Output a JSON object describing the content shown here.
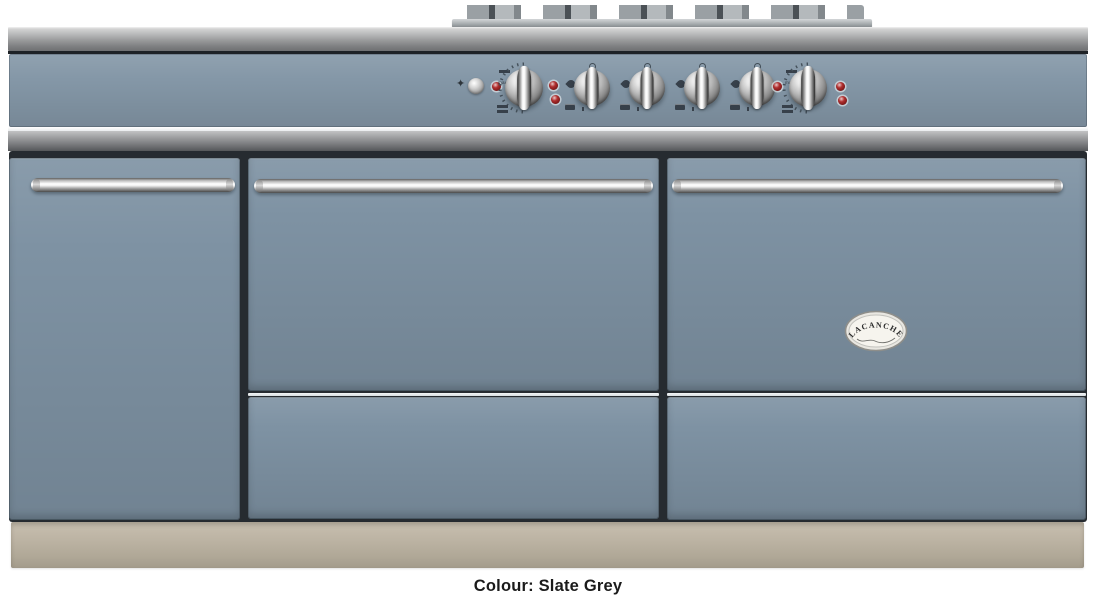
{
  "caption": {
    "text": "Colour: Slate Grey"
  },
  "badge": {
    "brand": "LACANCHE"
  },
  "control_panel": {
    "oven_scale_label": "maxi",
    "controls": [
      {
        "name": "ignition-spark-icon",
        "kind": "spark-symbol"
      },
      {
        "name": "ignition-button",
        "kind": "push-button"
      },
      {
        "name": "oven-knob-left",
        "kind": "oven-thermostat-knob"
      },
      {
        "name": "burner-knob-1",
        "kind": "gas-burner-knob"
      },
      {
        "name": "burner-knob-2",
        "kind": "gas-burner-knob"
      },
      {
        "name": "burner-knob-3",
        "kind": "gas-burner-knob"
      },
      {
        "name": "burner-knob-4",
        "kind": "gas-burner-knob"
      },
      {
        "name": "oven-knob-right",
        "kind": "oven-thermostat-knob"
      },
      {
        "name": "indicator-light",
        "kind": "red-indicator-lamp"
      }
    ]
  },
  "icons": {
    "ignition_spark": "✦",
    "flame": "teardrop-css-shape",
    "oven_grill": "single-bar",
    "oven_bake": "double-bar"
  },
  "colors": {
    "body_slate": "#7E92A3",
    "panel_slate": "#8497A7",
    "plinth_beige": "#B9B0A0",
    "indicator_red": "#8E1F1F",
    "gap_dark": "#262B30",
    "caption_text": "#1B1B1B"
  }
}
